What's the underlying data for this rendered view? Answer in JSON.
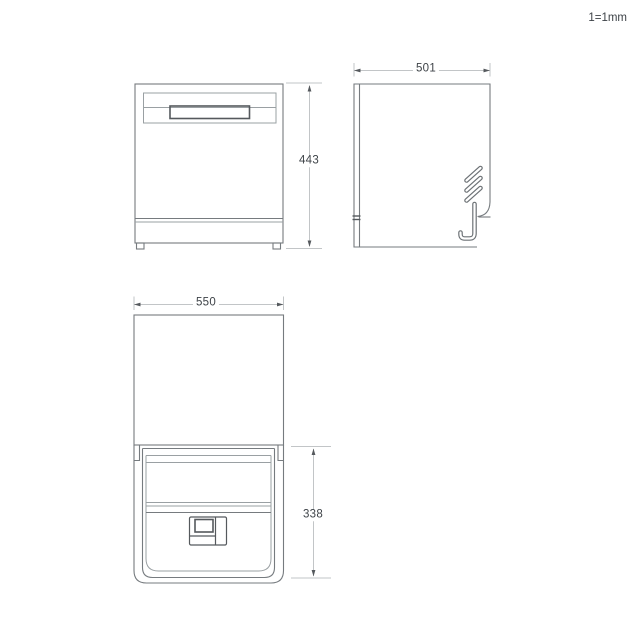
{
  "scale_note": "1=1mm",
  "dimensions": {
    "front_height": "443",
    "side_depth": "501",
    "plan_width": "550",
    "plan_door_depth": "338"
  },
  "colors": {
    "outline": "#767b7f",
    "outline_light": "#9aa0a3",
    "outline_dark": "#55595d",
    "dimension_line": "#c2c5c7",
    "text": "#3d4247",
    "background": "#ffffff"
  }
}
